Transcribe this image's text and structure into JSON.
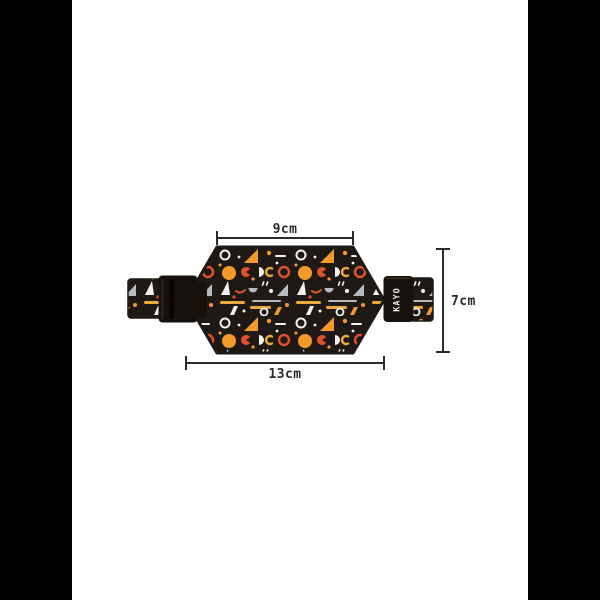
{
  "canvas": {
    "pillarbox_color": "#000000",
    "photo_background": "#ffffff"
  },
  "product": {
    "description": "flat belt bag (waist pouch) with memphis geometric print, front view with straps and buckles",
    "brand_label": "KAYO",
    "colors": {
      "fabric": "#1e1914",
      "orange": "#f39a2b",
      "red": "#e0512e",
      "yellow": "#ecaa3e",
      "white": "#f4f2ee",
      "gray": "#b7bbbf",
      "buckle": "#16110d",
      "buckle_detail": "#332c24",
      "buckle_slot": "#060505",
      "brand_text_color": "#e8e6e2"
    }
  },
  "annotations": {
    "line_color": "#2d2a27",
    "text_color": "#2b2b2b",
    "top_width_label": "9cm",
    "bottom_width_label": "13cm",
    "height_label": "7cm"
  }
}
